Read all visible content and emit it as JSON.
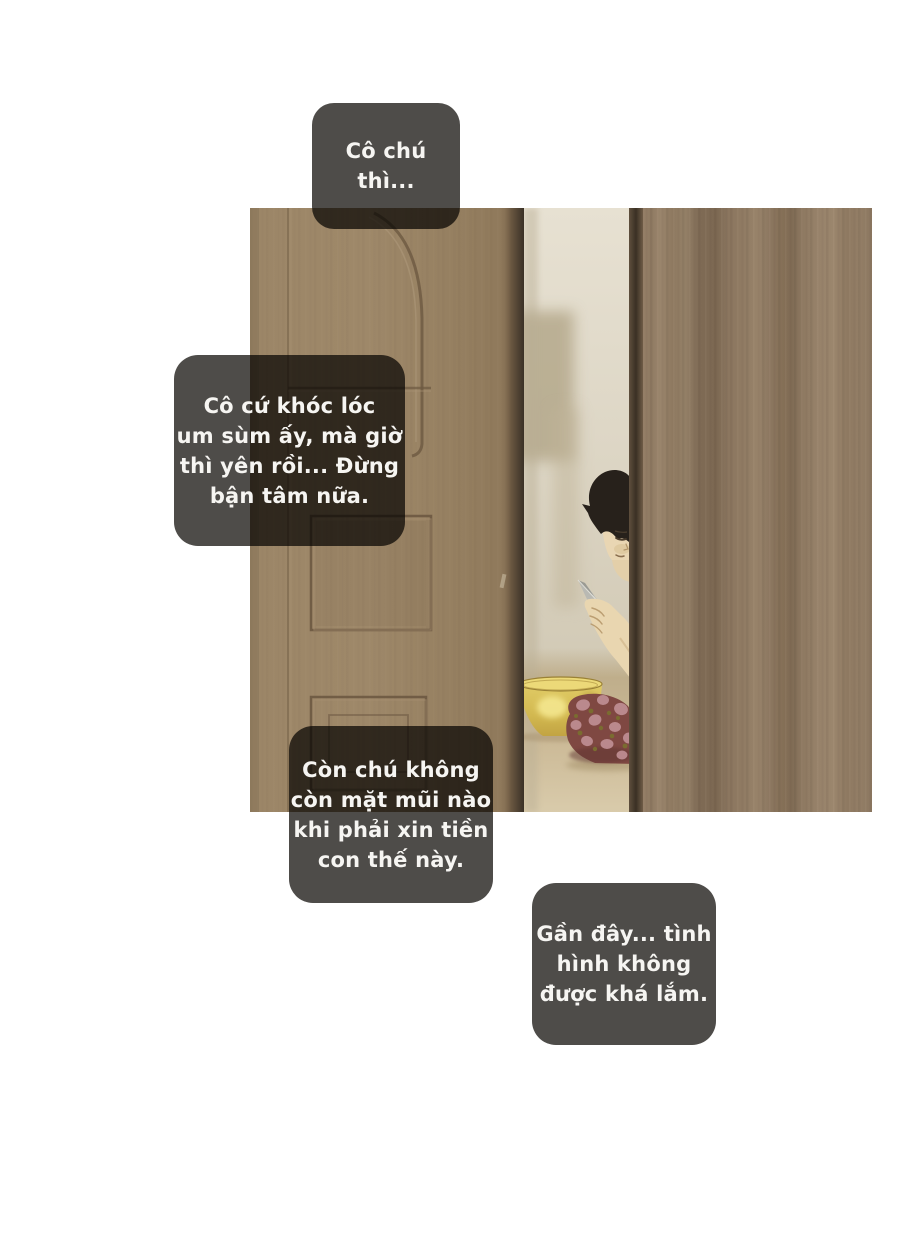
{
  "page": {
    "kind": "webtoon comic panel",
    "background": "#ffffff"
  },
  "bubbles": [
    {
      "name": "speech-bubble-top",
      "text": "Cô chú\nthì..."
    },
    {
      "name": "speech-bubble-left",
      "text": "Cô cứ khóc lóc\num sùm ấy, mà giờ\nthì yên rồi... Đừng\nbận tâm nữa."
    },
    {
      "name": "speech-bubble-bottom-left",
      "text": "Còn chú không\ncòn mặt mũi nào\nkhi phải xin tiền\ncon thế này."
    },
    {
      "name": "speech-bubble-bottom-right",
      "text": "Gần đây... tình\nhình không\nđược khá lắm."
    }
  ],
  "colors": {
    "bubble_bg": "#4e4c49",
    "bubble_text": "#f6f5f2",
    "door_brown": "#9c8667",
    "wood_panel_brown": "#8d7960",
    "wall_cream": "#ddd6c4",
    "floor_beige": "#cfc0a0",
    "bowl_yellow": "#d9c260",
    "cushion_maroon": "#7f4842",
    "hair_black": "#27211b",
    "skin_tone": "#e8d5b0",
    "knife_gray": "#b9b9b3"
  }
}
